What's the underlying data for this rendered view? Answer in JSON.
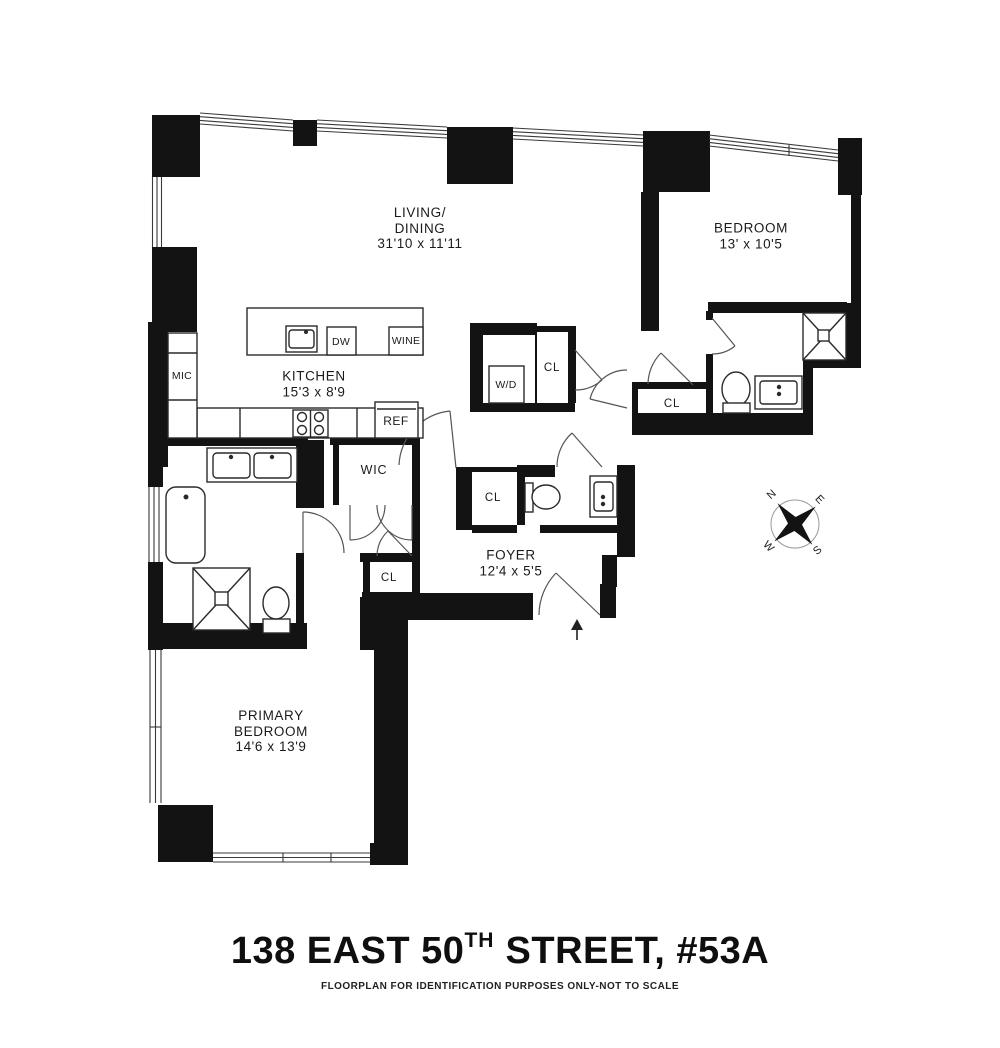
{
  "title": {
    "prefix": "138 EAST 50",
    "sup": "TH",
    "suffix": " STREET, #53A",
    "disclaimer": "FLOORPLAN FOR IDENTIFICATION PURPOSES ONLY-NOT TO SCALE"
  },
  "rooms": {
    "living_dining": {
      "l1": "LIVING/",
      "l2": "DINING",
      "dims": "31'10 x 11'11"
    },
    "bedroom": {
      "name": "BEDROOM",
      "dims": "13' x 10'5"
    },
    "kitchen": {
      "name": "KITCHEN",
      "dims": "15'3 x 8'9"
    },
    "primary_bedroom": {
      "l1": "PRIMARY",
      "l2": "BEDROOM",
      "dims": "14'6 x 13'9"
    },
    "foyer": {
      "name": "FOYER",
      "dims": "12'4 x 5'5"
    },
    "wic": {
      "name": "WIC"
    }
  },
  "closets": {
    "hall": "CL",
    "bedroom_hall": "CL",
    "foyer": "CL",
    "primary_hall": "CL"
  },
  "appliances": {
    "mic": "MIC",
    "dw": "DW",
    "wine": "WINE",
    "ref": "REF",
    "wd": "W/D"
  },
  "compass": {
    "n": "N",
    "e": "E",
    "s": "S",
    "w": "W"
  },
  "colors": {
    "wall": "#131313",
    "line": "#2a2a2a",
    "door": "#555555"
  }
}
